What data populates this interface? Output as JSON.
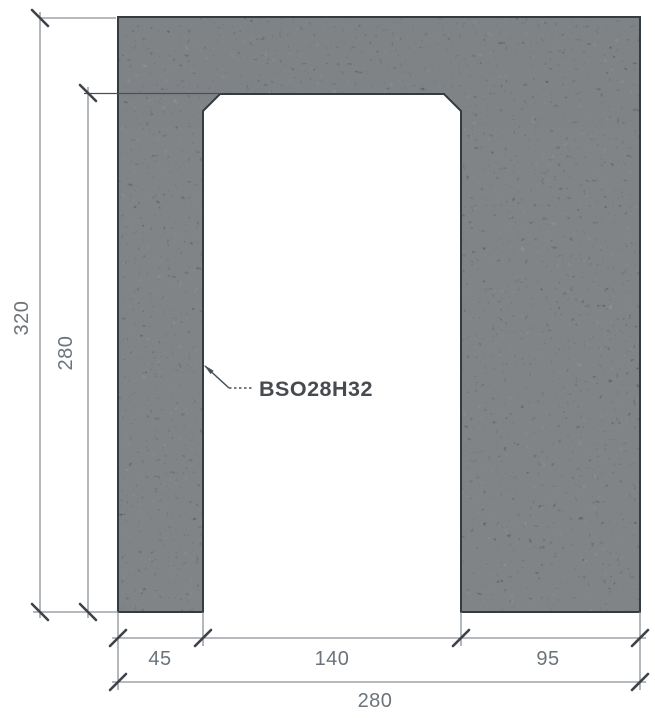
{
  "figure": {
    "type": "technical-section-drawing",
    "part_label": "BSO28H32"
  },
  "dimensions": {
    "overall_height": "320",
    "opening_height": "280",
    "left_pier_width": "45",
    "opening_width": "140",
    "right_pier_width": "95",
    "overall_width": "280"
  },
  "colors": {
    "background": "#ffffff",
    "texture_base": "#67717a",
    "block_outline": "#343b41",
    "dim_line": "#8a9197",
    "ext_line_on_block": "#4a5156",
    "tick": "#3d4349",
    "dim_text": "#6b747b",
    "label_text": "#454b50",
    "leader": "#4a5056"
  }
}
